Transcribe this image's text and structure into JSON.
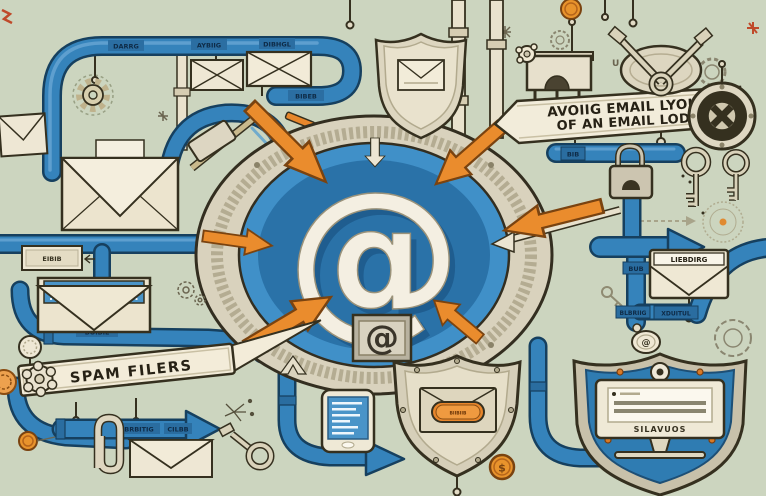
{
  "banner": {
    "line1": "AVOIIG EMAIL LYOUL",
    "line2": "OF AN EMAIL LODP"
  },
  "signs": {
    "spam": "SPAM FILERS"
  },
  "center": {
    "at": "@",
    "badge_at": "@",
    "charm_at": "@"
  },
  "pipe_labels": {
    "top_a": "DARRG",
    "top_b": "AYBIIG",
    "top_c": "DIBHGL",
    "loop": "BIBEB",
    "left_plaque": "EIBIB",
    "left_low": "BOIBIL",
    "flow_a": "BRBITIG",
    "flow_b": "CILBB",
    "right_tab": "BIB",
    "right_a": "BUB",
    "right_b": "BLBRIIG",
    "right_c": "XDUITUL"
  },
  "plaques": {
    "envelope_header": "LIEBDIRG",
    "monitor": "SILAVUOS",
    "capsule": "BIIBIIB",
    "corner_mark": "U"
  },
  "tokens": {
    "dollar": "$"
  },
  "colors": {
    "background": "#ccd5bf",
    "pipe_blue": "#3583bb",
    "pipe_dark": "#16405f",
    "accent_orange": "#ea8c2d",
    "cream": "#f0e9d6",
    "ink": "#35301f",
    "disc_blue": "#2a72a8",
    "metal": "#cfc8b2"
  }
}
